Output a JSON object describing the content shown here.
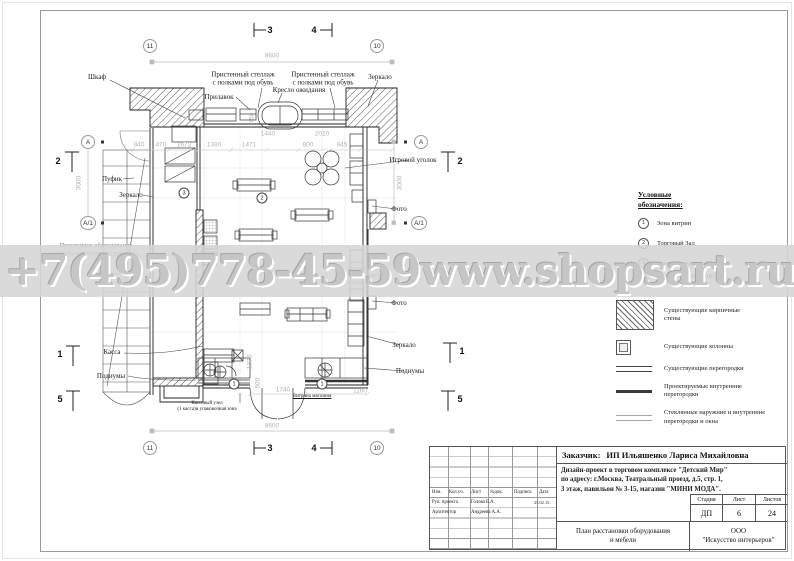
{
  "watermark": {
    "phone": "+7(495)778-45-59",
    "site": "www.shopsart.ru"
  },
  "legend_zones": {
    "title": "Условные\nобозначения:",
    "items": [
      {
        "num": "1",
        "label": "Зона витрин"
      },
      {
        "num": "2",
        "label": "Торговый Зал"
      },
      {
        "num": "3",
        "label": "Примерочная"
      }
    ]
  },
  "legend_symbols": {
    "title": "Условные обозначения:",
    "items": [
      {
        "symbol": "brick-hatch",
        "label": "Существующие кирпичные\nстены"
      },
      {
        "symbol": "column",
        "label": "Существующие колонны"
      },
      {
        "symbol": "existing-partition",
        "label": "Существующие перегородки"
      },
      {
        "symbol": "new-partition",
        "label": "Проектируемые внутренние\nперегородки"
      },
      {
        "symbol": "glass-partition",
        "label": "Стеклянные наружние и внутренние\nперегородки и окна"
      }
    ]
  },
  "plan": {
    "labels": [
      {
        "t": "Шкаф",
        "x": 97,
        "y": 77
      },
      {
        "t": "Пристенный стеллаж\nс полками под обувь",
        "x": 243,
        "y": 79
      },
      {
        "t": "Пристенный стеллаж\nс полками под обувь",
        "x": 323,
        "y": 79
      },
      {
        "t": "Прилавок",
        "x": 219,
        "y": 97
      },
      {
        "t": "Кресло ожидания",
        "x": 299,
        "y": 90
      },
      {
        "t": "Зеркало",
        "x": 380,
        "y": 77
      },
      {
        "t": "Игровой уголок",
        "x": 413,
        "y": 160
      },
      {
        "t": "Пуфик",
        "x": 112,
        "y": 179
      },
      {
        "t": "Зеркало",
        "x": 131,
        "y": 195
      },
      {
        "t": "Фото",
        "x": 399,
        "y": 209
      },
      {
        "t": "Фото",
        "x": 399,
        "y": 303
      },
      {
        "t": "Зеркало",
        "x": 404,
        "y": 345
      },
      {
        "t": "Подиумы",
        "x": 410,
        "y": 371
      },
      {
        "t": "Касса",
        "x": 112,
        "y": 352
      },
      {
        "t": "Подиумы",
        "x": 111,
        "y": 376
      },
      {
        "t": "Кассовый узел\n(1 касса)и упаковочная зона",
        "x": 207,
        "y": 407,
        "s": 5
      },
      {
        "t": "Витрина магазина",
        "x": 312,
        "y": 397,
        "s": 5,
        "u": 1
      },
      {
        "t": "Пристенное оборудование-\nтумбы накопители с полками",
        "x": 97,
        "y": 250,
        "grey": 1,
        "s": 6.5
      },
      {
        "t": "Детский столик\nв классическом\nстиле",
        "x": 348,
        "y": 277,
        "grey": 1,
        "s": 6,
        "a": "l"
      }
    ],
    "dimensions": [
      {
        "t": "8600",
        "x": 272,
        "y": 56
      },
      {
        "t": "8600",
        "x": 272,
        "y": 426
      },
      {
        "t": "3000",
        "x": 79,
        "y": 183,
        "r": 1
      },
      {
        "t": "3000",
        "x": 400,
        "y": 183,
        "r": 1
      },
      {
        "t": "1440",
        "x": 268,
        "y": 134
      },
      {
        "t": "2010",
        "x": 322,
        "y": 134
      },
      {
        "t": "940",
        "x": 139,
        "y": 145
      },
      {
        "t": "470",
        "x": 161,
        "y": 145
      },
      {
        "t": "1673",
        "x": 184,
        "y": 145
      },
      {
        "t": "1380",
        "x": 214,
        "y": 145
      },
      {
        "t": "1471",
        "x": 249,
        "y": 145
      },
      {
        "t": "800",
        "x": 308,
        "y": 145
      },
      {
        "t": "945",
        "x": 342,
        "y": 145
      },
      {
        "t": "750",
        "x": 252,
        "y": 118,
        "r": 1
      },
      {
        "t": "1740",
        "x": 283,
        "y": 390
      },
      {
        "t": "1160",
        "x": 360,
        "y": 391
      },
      {
        "t": "1375",
        "x": 250,
        "y": 362,
        "r": 1
      },
      {
        "t": "500",
        "x": 258,
        "y": 383,
        "r": 1
      }
    ],
    "grid_bubbles": [
      {
        "t": "11",
        "x": 150,
        "y": 46
      },
      {
        "t": "10",
        "x": 377,
        "y": 46
      },
      {
        "t": "11",
        "x": 150,
        "y": 448
      },
      {
        "t": "10",
        "x": 377,
        "y": 448
      }
    ],
    "axis_bubbles": [
      {
        "t": "А",
        "x": 88,
        "y": 142
      },
      {
        "t": "А/1",
        "x": 88,
        "y": 223
      },
      {
        "t": "А",
        "x": 421,
        "y": 142
      },
      {
        "t": "А/1",
        "x": 419,
        "y": 223
      }
    ],
    "section_markers": [
      {
        "t": "3",
        "x": 270,
        "y": 30
      },
      {
        "t": "4",
        "x": 314,
        "y": 30
      },
      {
        "t": "3",
        "x": 270,
        "y": 448
      },
      {
        "t": "4",
        "x": 314,
        "y": 448
      },
      {
        "t": "2",
        "x": 58,
        "y": 161
      },
      {
        "t": "1",
        "x": 60,
        "y": 354
      },
      {
        "t": "5",
        "x": 60,
        "y": 399
      },
      {
        "t": "2",
        "x": 460,
        "y": 161
      },
      {
        "t": "1",
        "x": 462,
        "y": 351
      },
      {
        "t": "5",
        "x": 460,
        "y": 399
      }
    ],
    "zone_marks": [
      {
        "t": "1",
        "x": 234,
        "y": 384
      },
      {
        "t": "1",
        "x": 322,
        "y": 384
      },
      {
        "t": "2",
        "x": 262,
        "y": 198
      },
      {
        "t": "3",
        "x": 184,
        "y": 193
      }
    ]
  },
  "title_block": {
    "customer_label": "Заказчик:",
    "customer": "ИП Ильяшенко Лариса Михайловна",
    "project_line1": "Дизайн-проект в  торговом  комплексе \"Детский Мир\"",
    "project_line2": "по адресу: г.Москва, Театральный проезд, д.5, стр. 1,",
    "project_line3": "3 этаж, павильон № 3-15, магазин \"МИНИ МОДА\".",
    "columns": [
      "Изм.",
      "Кол.уч.",
      "Лист",
      "№док.",
      "Подпись",
      "Дата"
    ],
    "rows": [
      {
        "role": "Рук. проекта",
        "name": "Голова Е.А.",
        "date": "25.02.15."
      },
      {
        "role": "Архитектор",
        "name": "Андреева А.А.",
        "date": ""
      }
    ],
    "stage_label": "Стадия",
    "sheet_label": "Лист",
    "sheets_label": "Листов",
    "stage": "ДП",
    "sheet": "6",
    "sheets": "24",
    "doc_title_line1": "План расстановки оборудования",
    "doc_title_line2": "и мебели",
    "company_line1": "ООО",
    "company_line2": "\"Искусство интерьеров\""
  }
}
